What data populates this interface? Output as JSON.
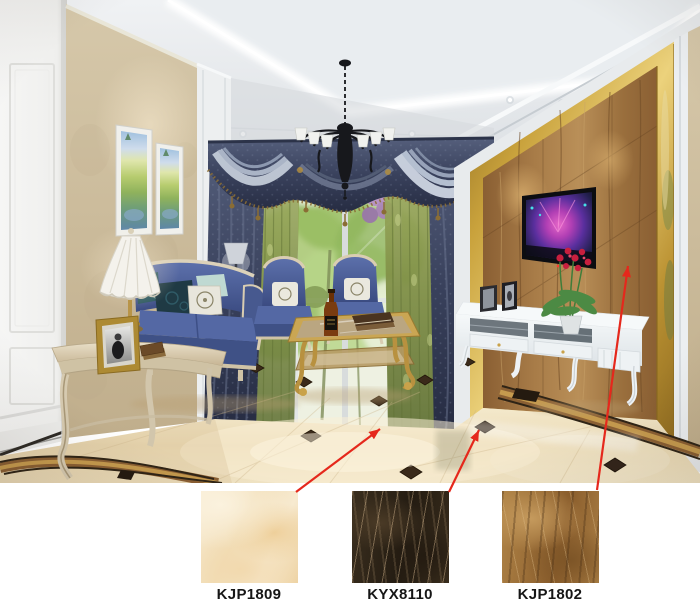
{
  "products": [
    {
      "code": "KJP1809",
      "swatch_color": "#f3e2c0",
      "arrow": {
        "from_x": 296,
        "from_y": 492,
        "to_x": 380,
        "to_y": 429
      }
    },
    {
      "code": "KYX8110",
      "swatch_color": "#32281b",
      "arrow": {
        "from_x": 449,
        "from_y": 492,
        "to_x": 479,
        "to_y": 430
      }
    },
    {
      "code": "KJP1802",
      "swatch_color": "#a4763c",
      "arrow": {
        "from_x": 597,
        "from_y": 490,
        "to_x": 628,
        "to_y": 266
      }
    }
  ],
  "annotation": {
    "arrow_color": "#e5281c",
    "label_color": "#161616"
  },
  "scene_colors": {
    "floor_tile": "#eadcba",
    "floor_insert": "#3a2a1a",
    "tv_wall_marble": "#9c7040",
    "gold_trim": "#c8a23c",
    "sofa_fabric": "#4a5f9e",
    "curtain_drape": "#46506b",
    "curtain_sheer": "#8a9a52",
    "wallpaper": "#cfc0a2",
    "ceiling": "#e3e6e9",
    "background": "#ffffff"
  }
}
